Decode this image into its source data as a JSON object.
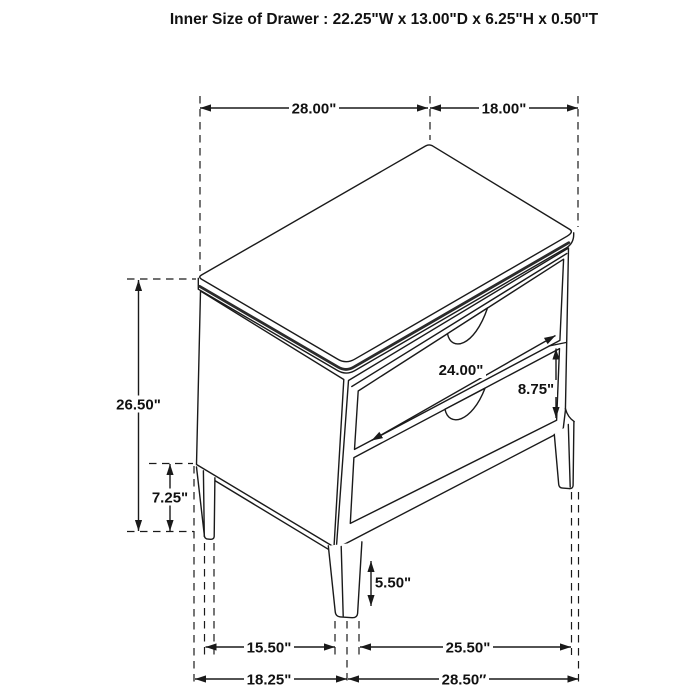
{
  "title": "Inner Size of Drawer : 22.25\"W x 13.00\"D x 6.25\"H x 0.50\"T",
  "colors": {
    "background": "#ffffff",
    "line": "#1a1a1a",
    "accent_edge": "#2b2b2b"
  },
  "dim_labels": {
    "top_width": "28.00\"",
    "top_depth": "18.00\"",
    "overall_height": "26.50\"",
    "bottom_clearance": "7.25\"",
    "drawer_width": "24.00\"",
    "drawer_height": "8.75\"",
    "leg_height": "5.50\"",
    "legs_side_span": "15.50\"",
    "legs_front_span": "25.50\"",
    "base_side_width": "18.25\"",
    "base_front_width": "28.50″"
  }
}
